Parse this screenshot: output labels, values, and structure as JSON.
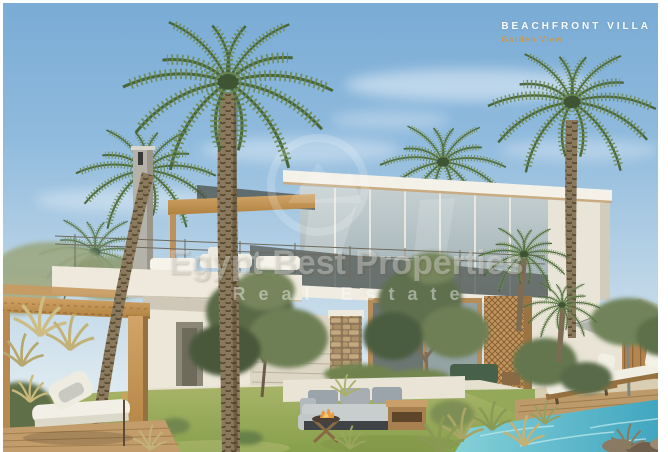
{
  "photo": {
    "label": {
      "title": "BEACHFRONT VILLA",
      "subtitle": "Garden View"
    },
    "watermark": {
      "brand": "Egypt Best Properties",
      "tagline": "Real Estate"
    },
    "palette": {
      "sky_top": "#79abd5",
      "sky_horizon": "#dde9f0",
      "villa_white": "#efebe0",
      "glass": "#b3c2c6",
      "wood": "#c2945e",
      "stone": "#b29873",
      "grass": "#97a75a",
      "pool_water": "#4fb0c6",
      "palm_green": "#5f7d4b",
      "gold_accent": "#c59a4f"
    }
  }
}
